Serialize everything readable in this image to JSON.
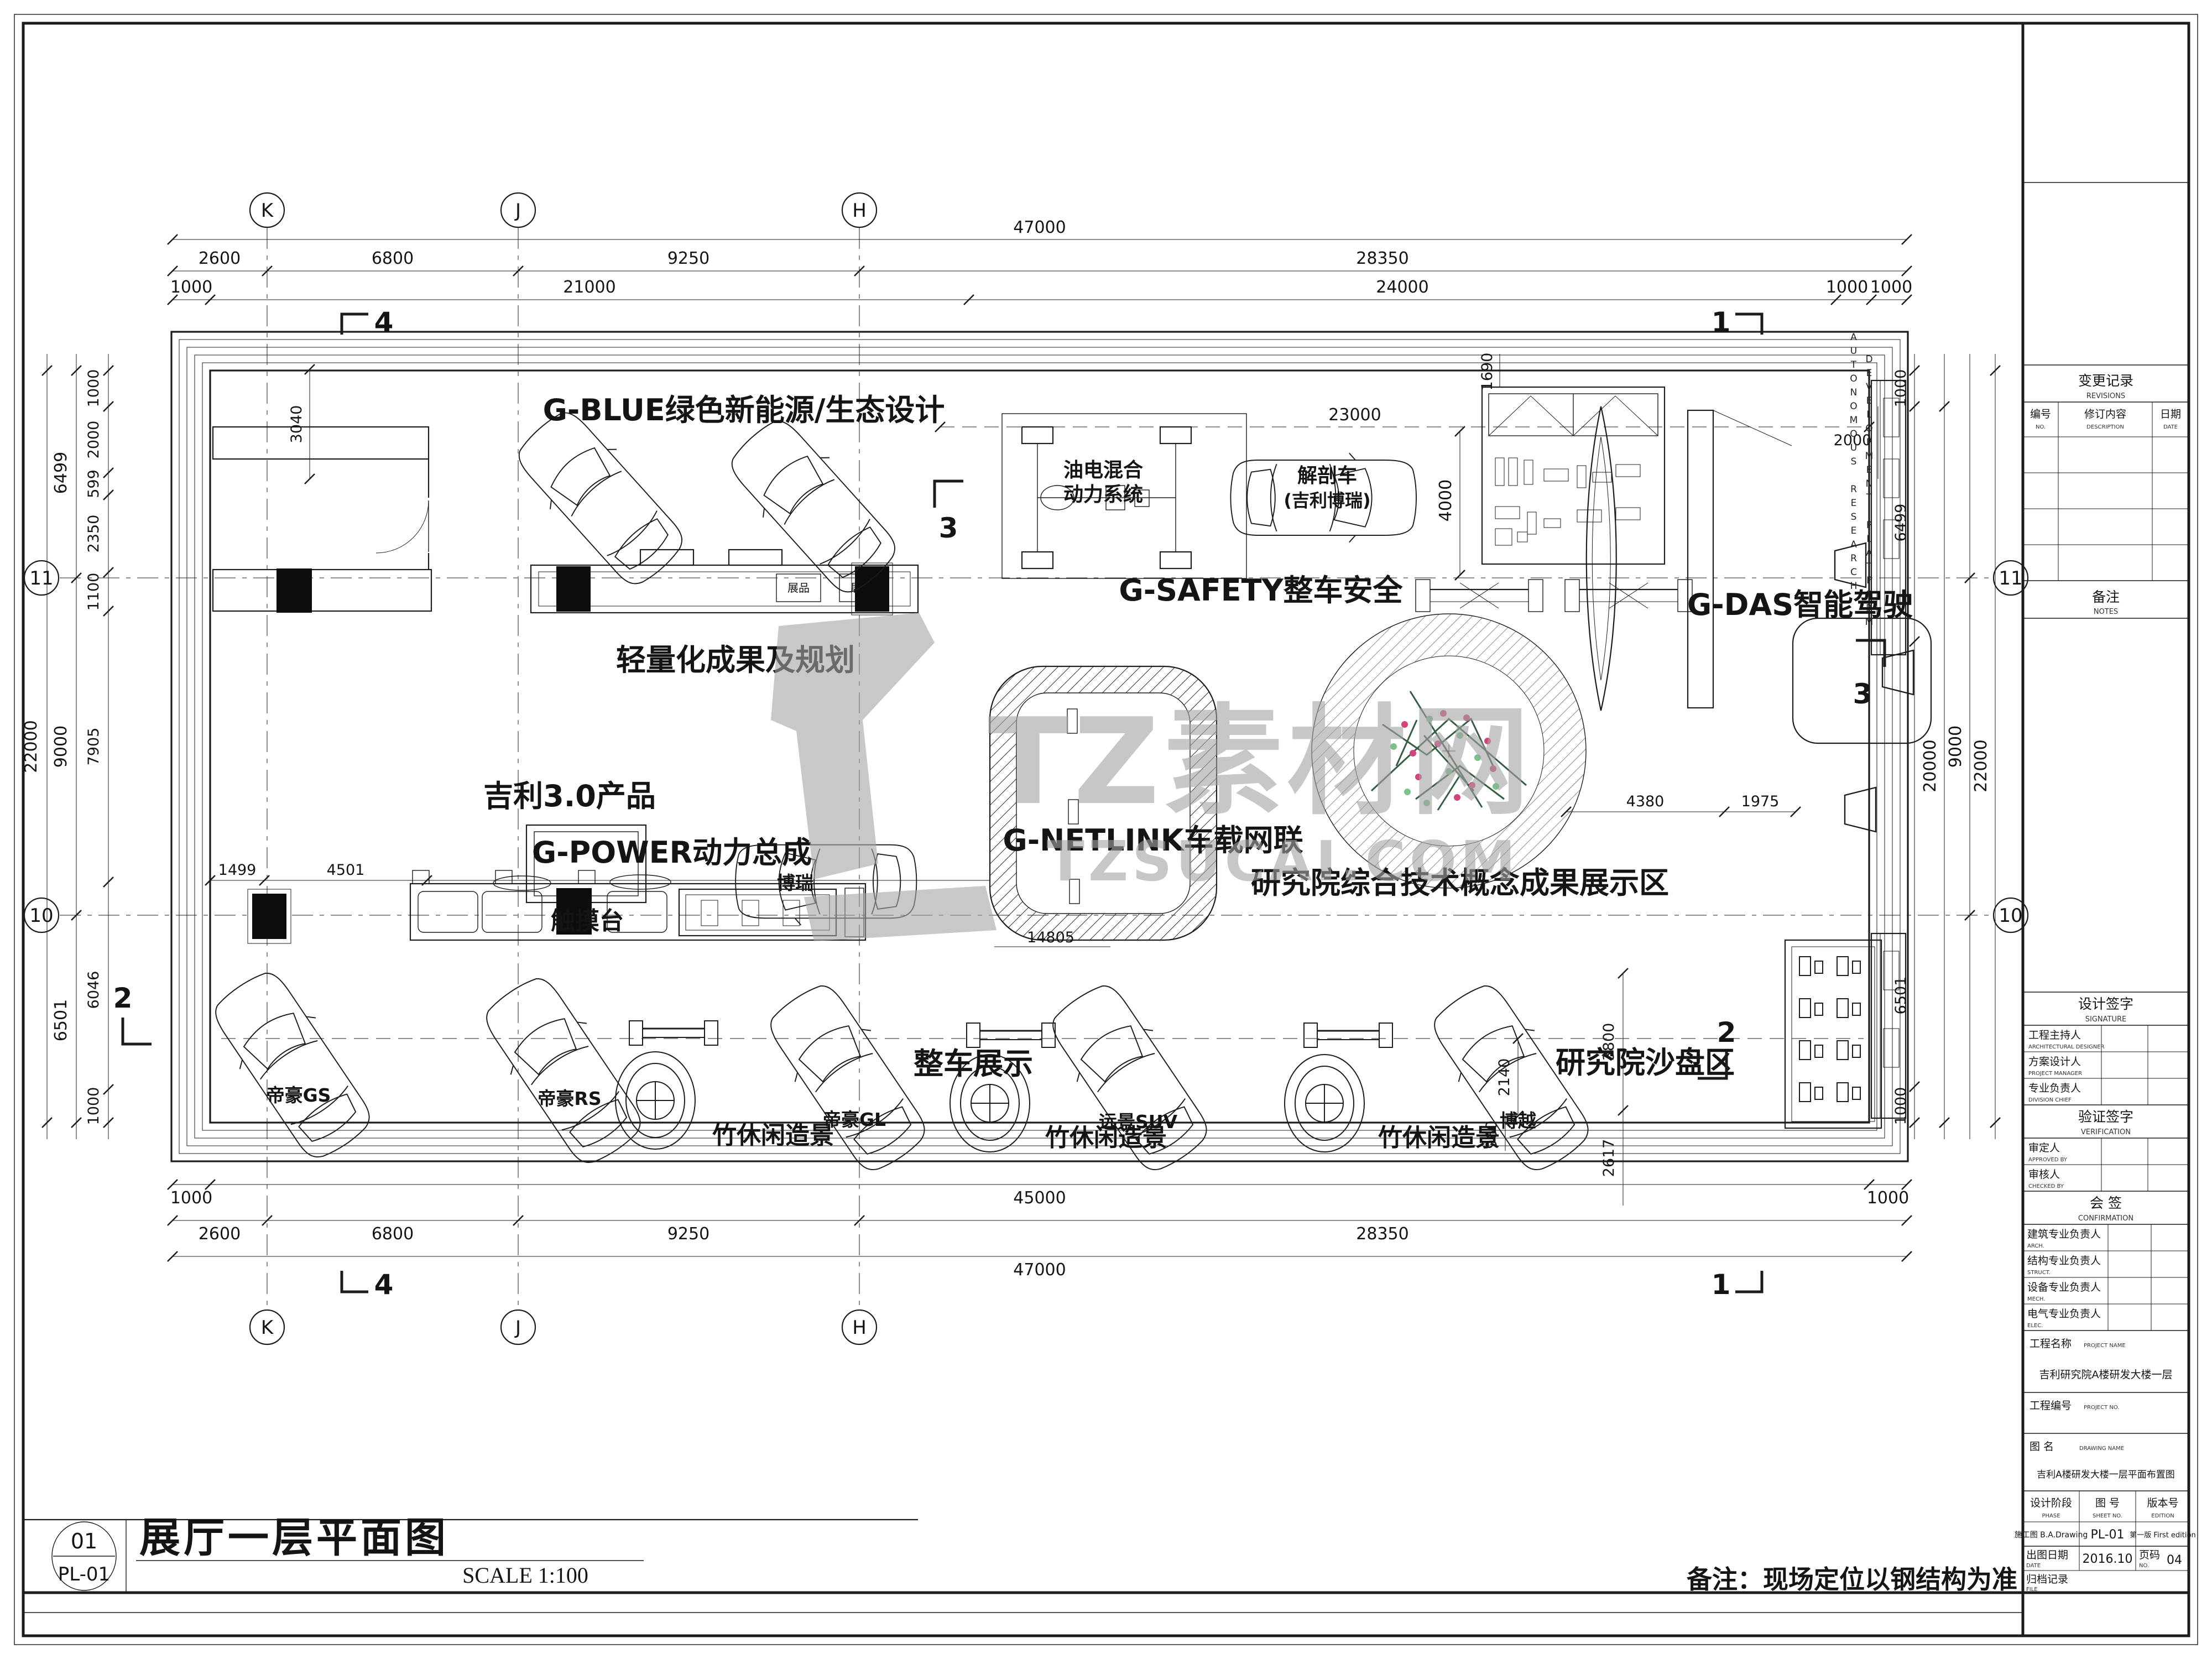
{
  "watermark": {
    "brand": "TZ素材网",
    "domain": "TZSUCAI.COM"
  },
  "titlebar": {
    "fig_no": "01",
    "sheet_no": "PL-01",
    "title": "展厅一层平面图",
    "scale": "SCALE 1:100"
  },
  "note": "备注：现场定位以钢结构为准",
  "grid": {
    "k": "K",
    "j": "J",
    "h": "H",
    "r11": "11",
    "r10": "10"
  },
  "dims": {
    "top1": "47000",
    "top2": [
      "2600",
      "6800",
      "9250",
      "28350"
    ],
    "top3": [
      "1000",
      "21000",
      "24000",
      "1000",
      "1000"
    ],
    "bot1": [
      "1000",
      "45000",
      "1000"
    ],
    "bot2": [
      "2600",
      "6800",
      "9250",
      "28350"
    ],
    "bot3": "47000",
    "left_outer": "22000",
    "left_mid": [
      "6499",
      "9000",
      "6501"
    ],
    "left_inner": [
      "1000",
      "2000",
      "599",
      "2350",
      "1100",
      "7905",
      "6046",
      "1000"
    ],
    "right_inner": [
      "1000",
      "6499",
      "6501",
      "1000"
    ],
    "right_outer": [
      "20000",
      "9000",
      "22000"
    ],
    "d3040": "3040",
    "d23000": "23000",
    "d1690": "1690",
    "d4000": "4000",
    "d2000": "2000",
    "d1499": "1499",
    "d4501": "4501",
    "d14805": "14805",
    "d4380": "4380",
    "d1975": "1975",
    "d3800": "3800",
    "d2617": "2617",
    "d2140": "2140",
    "d960": "960"
  },
  "sections": {
    "s1": "1",
    "s2": "2",
    "s3": "3",
    "s4": "4"
  },
  "zones": {
    "g_blue": "G-BLUE绿色新能源/生态设计",
    "lightweight": "轻量化成果及规划",
    "geely30": "吉利3.0产品",
    "touch": "触摸台",
    "g_power": "G-POWER动力总成",
    "g_safety": "G-SAFETY整车安全",
    "hybrid1": "油电混合",
    "hybrid2": "动力系统",
    "anatomy1": "解剖车",
    "anatomy2": "(吉利博瑞)",
    "g_netlink": "G-NETLINK车载网联",
    "g_das": "G-DAS智能驾驶",
    "das_en1": "AUTONOMOUS RESEARCH",
    "das_en2": "DEVELOPMENT PLATFORM",
    "research": "研究院综合技术概念成果展示区",
    "sandbox": "研究院沙盘区",
    "display": "整车展示",
    "bamboo": "竹休闲造景",
    "exhibit": "展品"
  },
  "cars": {
    "gs": "帝豪GS",
    "rs": "帝豪RS",
    "gl": "帝豪GL",
    "suv": "远景SUV",
    "boyue": "博越",
    "borui": "博瑞"
  },
  "tb": {
    "rev": {
      "cn": "变更记录",
      "en": "REVISIONS",
      "no_cn": "编号",
      "no_en": "NO.",
      "desc_cn": "修订内容",
      "desc_en": "DESCRIPTION",
      "date_cn": "日期",
      "date_en": "DATE"
    },
    "notes": {
      "cn": "备注",
      "en": "NOTES"
    },
    "sig": {
      "cn": "设计签字",
      "en": "SIGNATURE",
      "r": [
        [
          "工程主持人",
          "ARCHITECTURAL DESIGNER"
        ],
        [
          "方案设计人",
          "PROJECT MANAGER"
        ],
        [
          "专业负责人",
          "DIVISION CHIEF"
        ]
      ]
    },
    "ver": {
      "cn": "验证签字",
      "en": "VERIFICATION",
      "r": [
        [
          "审定人",
          "APPROVED BY"
        ],
        [
          "审核人",
          "CHECKED BY"
        ]
      ]
    },
    "conf": {
      "cn": "会  签",
      "en": "CONFIRMATION",
      "r": [
        [
          "建筑专业负责人",
          "ARCH."
        ],
        [
          "结构专业负责人",
          "STRUCT."
        ],
        [
          "设备专业负责人",
          "MECH."
        ],
        [
          "电气专业负责人",
          "ELEC."
        ]
      ]
    },
    "pname": {
      "cn": "工程名称",
      "en": "PROJECT NAME",
      "v": "吉利研究院A楼研发大楼一层"
    },
    "pno": {
      "cn": "工程编号",
      "en": "PROJECT NO."
    },
    "dname": {
      "cn": "图  名",
      "en": "DRAWING NAME",
      "v": "吉利A楼研发大楼一层平面布置图"
    },
    "phase": {
      "cn": "设计阶段",
      "en": "PHASE",
      "v": "施工图 B.A.Drawing"
    },
    "sheet": {
      "cn": "图 号",
      "en": "SHEET NO.",
      "v": "PL-01"
    },
    "edition": {
      "cn": "版本号",
      "en": "EDITION",
      "v": "第一版 First edition"
    },
    "date": {
      "cn": "出图日期",
      "en": "DATE",
      "v": "2016.10"
    },
    "page": {
      "cn": "页码",
      "en": "NO.",
      "v": "04"
    },
    "file": {
      "cn": "归档记录",
      "en": "FILE"
    }
  }
}
